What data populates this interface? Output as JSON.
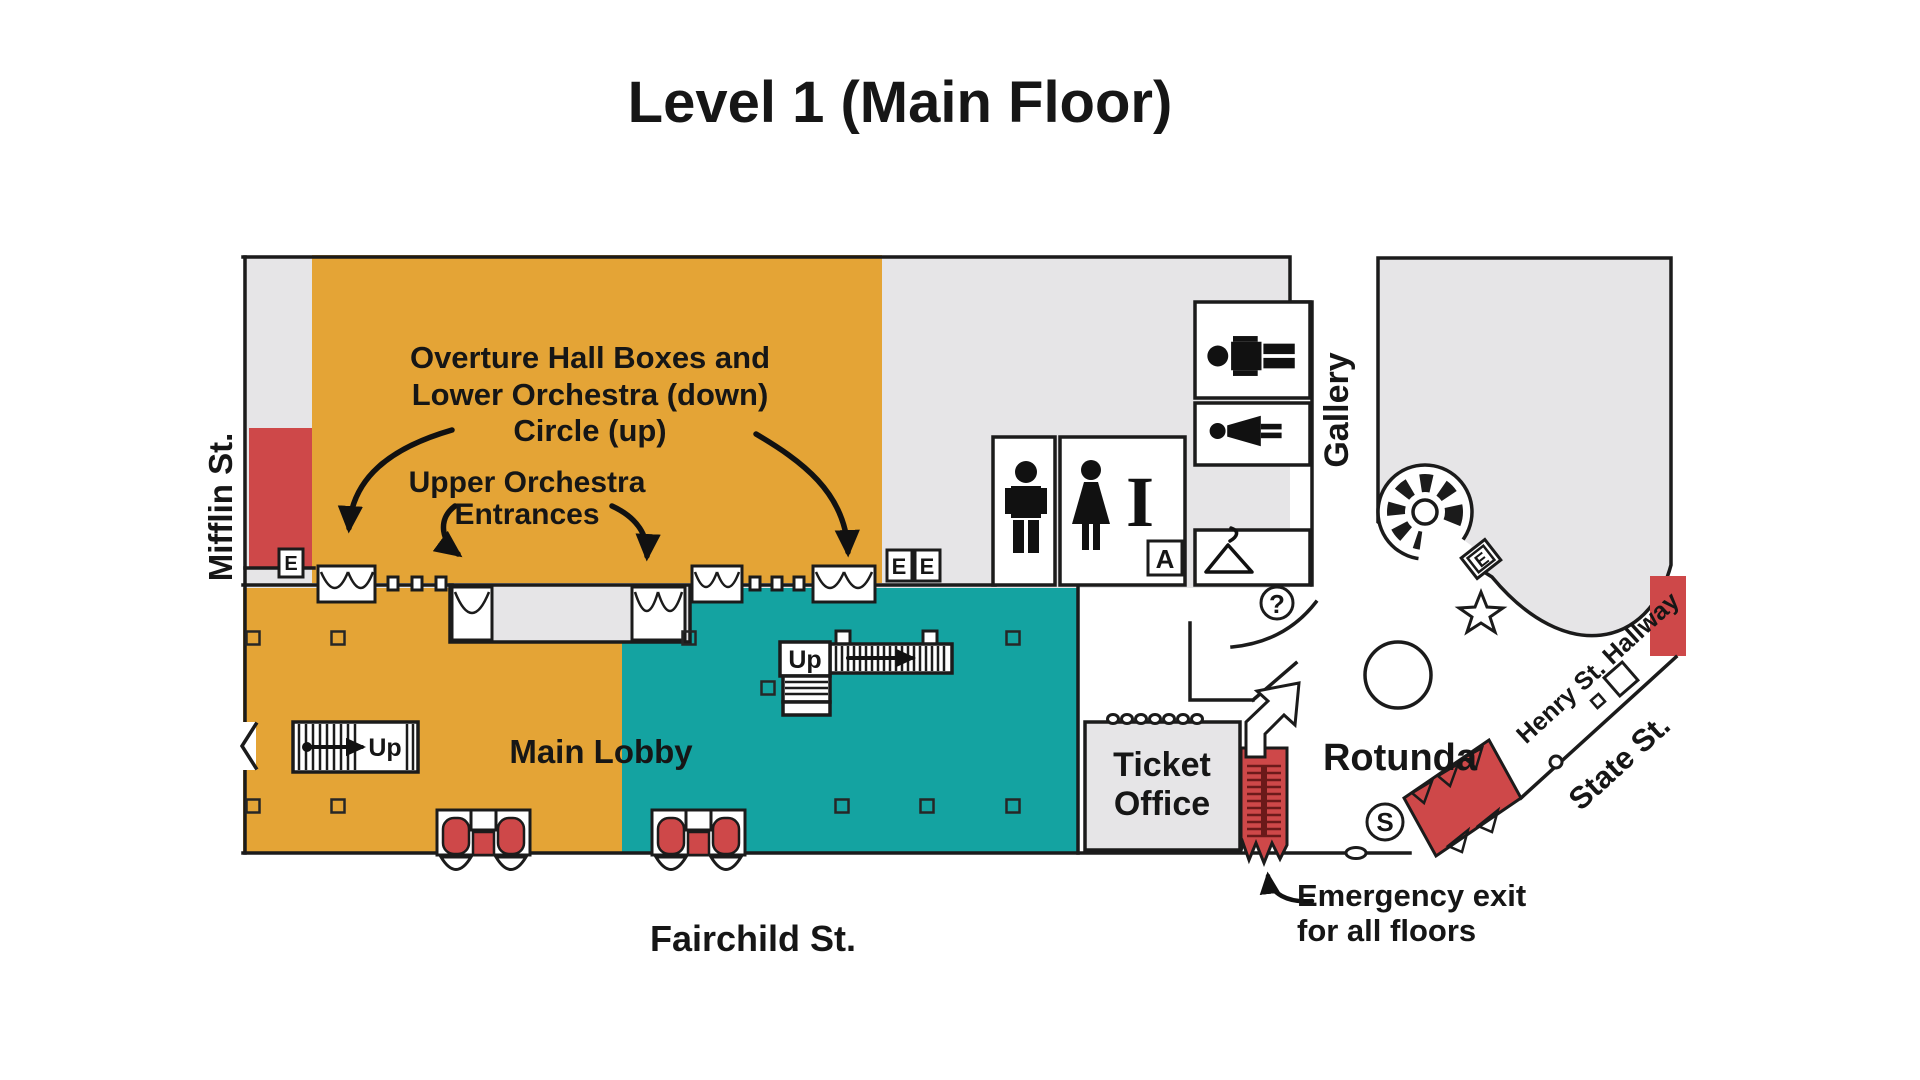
{
  "title": "Level 1 (Main Floor)",
  "annotations": {
    "overture_l1": "Overture Hall Boxes and",
    "overture_l2": "Lower Orchestra (down)",
    "overture_l3": "Circle (up)",
    "upper_l1": "Upper Orchestra",
    "upper_l2": "Entrances",
    "emergency_l1": "Emergency exit",
    "emergency_l2": "for all floors"
  },
  "streets": {
    "mifflin": "Mifflin St.",
    "fairchild": "Fairchild St.",
    "state": "State St.",
    "henry_hallway": "Henry St. Hallway"
  },
  "rooms": {
    "main_lobby": "Main Lobby",
    "ticket_l1": "Ticket",
    "ticket_l2": "Office",
    "rotunda": "Rotunda",
    "gallery": "Gallery"
  },
  "markers": {
    "up_left": "Up",
    "up_center": "Up",
    "elevator_mifflin": "E",
    "elevator_pair_left": "E",
    "elevator_pair_right": "E",
    "elevator_rotunda": "E",
    "accessible_room": "A",
    "stair_s": "S",
    "info_question": "?",
    "information_i": "I"
  },
  "colors": {
    "orange": "#E4A436",
    "teal": "#14A3A1",
    "red": "#CE4849",
    "gray": "#E6E5E7",
    "wall": "#1B1B1B",
    "text": "#161616"
  }
}
